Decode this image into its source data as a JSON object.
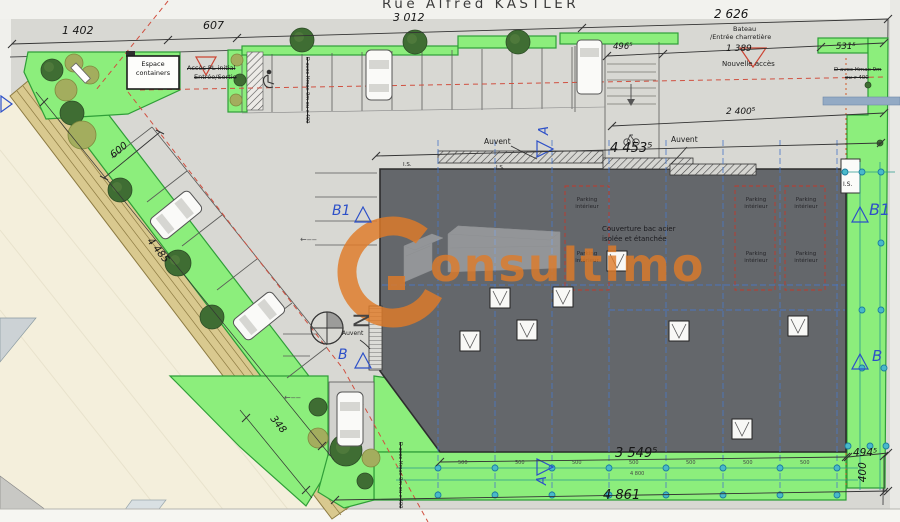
{
  "street": {
    "name": "Rue Alfred KASTLER"
  },
  "watermark": {
    "letter": "C",
    "text": "onsultimo",
    "color": "#e07b28"
  },
  "dims": {
    "top1": "1 402",
    "top2": "607",
    "top3": "3 012",
    "top4": "2 626",
    "access_width": "496⁵",
    "gate": "1 389",
    "right_top": "531⁵",
    "courtyard": "2 400⁵",
    "building_top": "4 453⁵",
    "left_depth": "600",
    "boulevard": "4 485",
    "left_bottom": "348",
    "building_bottom": "3 549⁵",
    "right_bottom": "494⁵",
    "right_height": "400",
    "bottom_total": "4 861",
    "bay": "500",
    "bay_total": "4 800"
  },
  "labels": {
    "espace1": "Espace",
    "espace2": "containers",
    "acces1": "Accès PL initial",
    "acces2": "Entrée/Sortie",
    "bateau1": "Bateau",
    "bateau2": "/Entrée charretière",
    "nouvelle": "Nouvelle accès",
    "hmax1": "D avec Hmax 9m",
    "hmax2": "ou >400",
    "hmax_inline": "D avec Hmax 9m ou >400",
    "auvent": "Auvent",
    "parking1": "Parking",
    "parking2": "intérieur",
    "couverture1": "Couverture bac acier",
    "couverture2": "isolée et étanchée",
    "is": "I.S.",
    "north": "N",
    "arrow_left": "←‒‒"
  },
  "markers": {
    "a": "A",
    "b": "B",
    "b1": "B1"
  },
  "colors": {
    "accent_orange": "#e07b28",
    "green_area": "#8cee7c",
    "building_gray": "#64676b",
    "marker_blue": "#2d50c8",
    "alert_red": "#cc4433",
    "node_teal": "#49b9c9",
    "road_beige": "#f4efdc"
  }
}
